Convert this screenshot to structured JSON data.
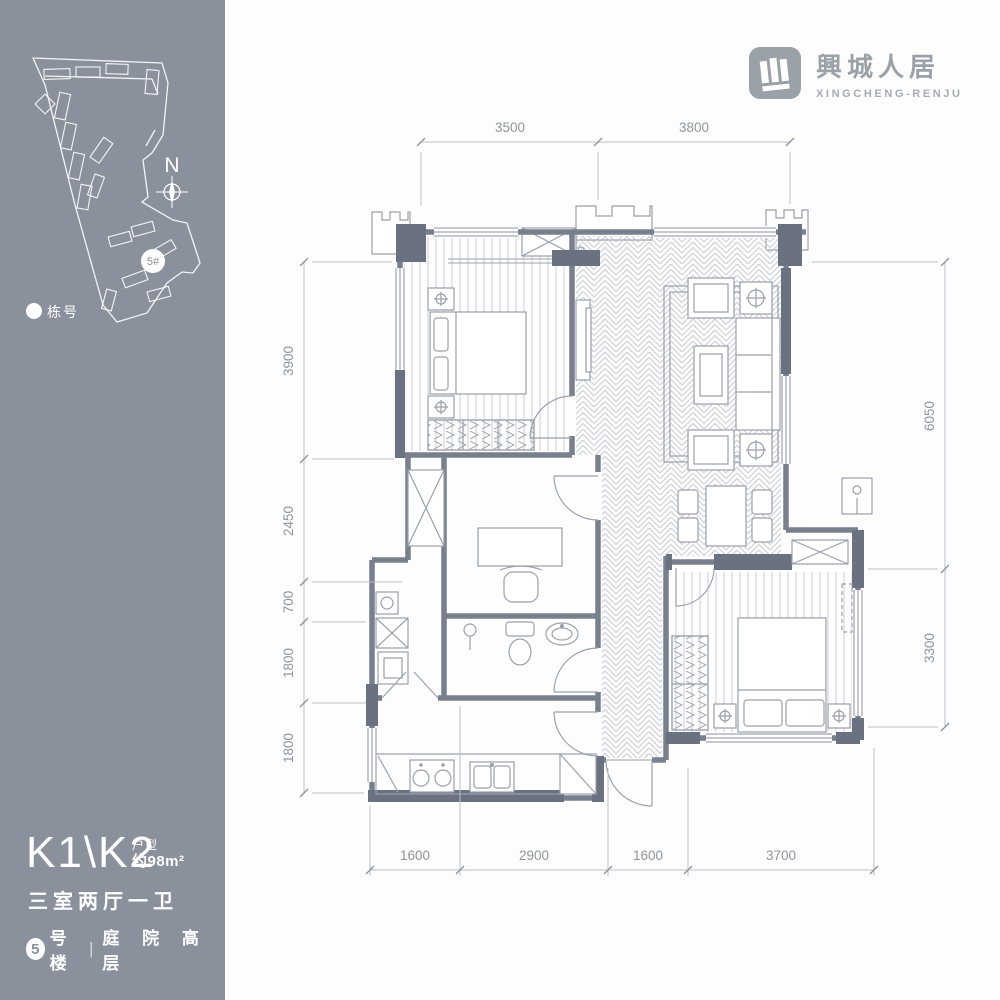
{
  "brand": {
    "logo_cn": "興城人居",
    "logo_en": "XINGCHENG-RENJU"
  },
  "sidebar": {
    "north_label": "N",
    "building_marker": "5#",
    "legend_label": "栋号"
  },
  "unit": {
    "name": "K1\\K2",
    "type_label": "户型",
    "area": "约98m²",
    "rooms": "三室两厅一卫",
    "building_num": "5",
    "building_label": "号楼",
    "divider": "|",
    "feature": "庭 院 高 层"
  },
  "dims": {
    "top": [
      "3500",
      "3800"
    ],
    "left": [
      "3900",
      "2450",
      "700",
      "1800",
      "1800"
    ],
    "right": [
      "6050",
      "3300"
    ],
    "bottom": [
      "1600",
      "2900",
      "1600",
      "3700"
    ]
  },
  "colors": {
    "sidebar": "#8a919d",
    "wall": "#6a7180",
    "wallline": "#78808d",
    "thin": "#9aa1ab",
    "dim": "#8f959d",
    "logo": "#9ba1a9"
  }
}
